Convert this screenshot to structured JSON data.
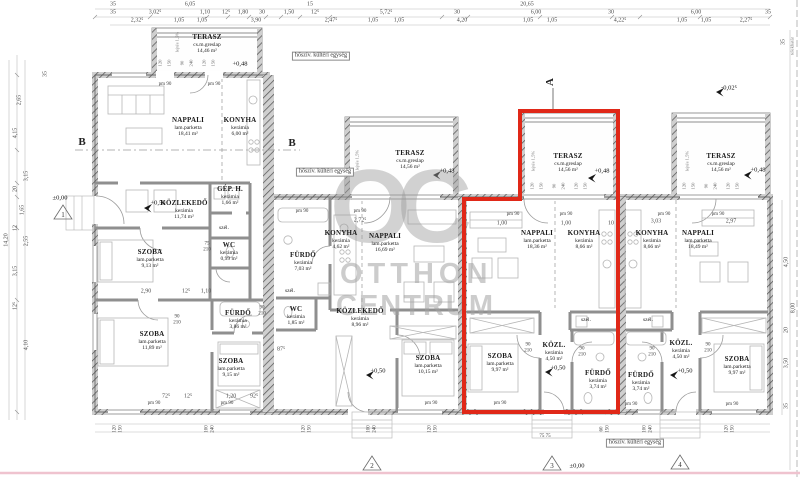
{
  "watermark": {
    "monogram": "OC",
    "line1": "OTTHON",
    "line2": "CENTRUM"
  },
  "labels": {
    "door": "pm 90",
    "heat_pump": "hőszív. kültéri egység",
    "plot_boundary": "telekhatár",
    "slope": "lejtés 1,5%",
    "section_a": "A",
    "section_b": "B"
  },
  "levels": [
    "±0,00",
    "+0,48",
    "+0,48",
    "+0,48",
    "+0,48",
    "+0,50",
    "+0,50",
    "+0,50",
    "+0,50",
    "-0,02⁵",
    "±0,00"
  ],
  "markers": [
    "1",
    "2",
    "3",
    "4"
  ],
  "units": [
    {
      "id": "unit-1",
      "rooms": [
        {
          "name": "TERASZ",
          "material": "cs.m.greslap",
          "area": "14,46 m²"
        },
        {
          "name": "NAPPALI",
          "material": "lam.parketta",
          "area": "18,41 m²"
        },
        {
          "name": "KONYHA",
          "material": "kerámia",
          "area": "6,00 m²"
        },
        {
          "name": "KÖZLEKEDŐ",
          "material": "kerámia",
          "area": "11,74 m²"
        },
        {
          "name": "GÉP. H.",
          "material": "kerámia",
          "area": "1,66 m²"
        },
        {
          "name": "WC",
          "material": "kerámia",
          "area": "0,99 m²"
        },
        {
          "name": "SZOBA",
          "material": "lam.parketta",
          "area": "9,13 m²"
        },
        {
          "name": "SZOBA",
          "material": "lam.parketta",
          "area": "11,89 m²"
        },
        {
          "name": "FÜRDŐ",
          "material": "kerámia",
          "area": "3,86 m²"
        },
        {
          "name": "SZOBA",
          "material": "lam.parketta",
          "area": "9,15 m²"
        },
        {
          "name": "szél."
        }
      ]
    },
    {
      "id": "unit-2",
      "rooms": [
        {
          "name": "TERASZ",
          "material": "cs.m.greslap",
          "area": "14,56 m²"
        },
        {
          "name": "FÜRDŐ",
          "material": "kerámia",
          "area": "7,03 m²"
        },
        {
          "name": "KONYHA",
          "material": "kerámia",
          "area": "4,62 m²"
        },
        {
          "name": "NAPPALI",
          "material": "lam.parketta",
          "area": "16,69 m²"
        },
        {
          "name": "WC",
          "material": "kerámia",
          "area": "1,85 m²"
        },
        {
          "name": "KÖZLEKEDŐ",
          "material": "kerámia",
          "area": "8,96 m²"
        },
        {
          "name": "SZOBA",
          "material": "lam.parketta",
          "area": "10,15 m²"
        },
        {
          "name": "szél."
        }
      ]
    },
    {
      "id": "unit-3",
      "highlighted": true,
      "rooms": [
        {
          "name": "TERASZ",
          "material": "cs.m.greslap",
          "area": "14,56 m²"
        },
        {
          "name": "NAPPALI",
          "material": "lam.parketta",
          "area": "18,36 m²"
        },
        {
          "name": "KONYHA",
          "material": "kerámia",
          "area": "8,66 m²"
        },
        {
          "name": "SZOBA",
          "material": "lam.parketta",
          "area": "9,97 m²"
        },
        {
          "name": "KÖZL.",
          "material": "kerámia",
          "area": "4,50 m²"
        },
        {
          "name": "FÜRDŐ",
          "material": "kerámia",
          "area": "3,74 m²"
        },
        {
          "name": "szél."
        }
      ]
    },
    {
      "id": "unit-4",
      "rooms": [
        {
          "name": "TERASZ",
          "material": "cs.m.greslap",
          "area": "14,56 m²"
        },
        {
          "name": "KONYHA",
          "material": "kerámia",
          "area": "8,66 m²"
        },
        {
          "name": "NAPPALI",
          "material": "lam.parketta",
          "area": "18,49 m²"
        },
        {
          "name": "FÜRDŐ",
          "material": "kerámia",
          "area": "3,74 m²"
        },
        {
          "name": "KÖZL.",
          "material": "kerámia",
          "area": "4,50 m²"
        },
        {
          "name": "SZOBA",
          "material": "lam.parketta",
          "area": "9,97 m²"
        },
        {
          "name": "szél."
        }
      ]
    }
  ],
  "dims": {
    "top1": [
      "35",
      "6,05",
      "15",
      "20,65"
    ],
    "top2": [
      "35",
      "3,02⁵",
      "1,10",
      "12⁵",
      "1,80",
      "30",
      "1,50",
      "12⁵",
      "5,72⁵",
      "30",
      "6,00",
      "30",
      "6,00",
      "35"
    ],
    "top3": [
      "2,32⁵",
      "1,05",
      "1,05",
      "3,90",
      "2,47⁵",
      "1,05",
      "1,05",
      "4,20",
      "1,05",
      "1,05",
      "4,22⁵",
      "1,05",
      "1,05",
      "2,27⁵"
    ],
    "left": [
      "35",
      "2,65",
      "4,15",
      "3,15",
      "20",
      "1,65",
      "12",
      "2,55",
      "3,15",
      "12⁵",
      "4,10",
      "14,20"
    ],
    "right": [
      "35",
      "4,50",
      "8,00",
      "20",
      "3,50",
      "35"
    ],
    "interior": [
      "2,90",
      "12⁵",
      "1,10",
      "2,72⁵",
      "1,00",
      "1,00",
      "10",
      "3,03",
      "2,97",
      "72⁵",
      "12⁵",
      "1,20",
      "92⁵",
      "87⁵"
    ],
    "win": [
      "120",
      "150",
      "90",
      "240",
      "120",
      "150"
    ],
    "door_pairs": [
      [
        "75",
        "210"
      ],
      [
        "90",
        "210"
      ],
      [
        "90",
        "210"
      ],
      [
        "90",
        "210"
      ],
      [
        "90",
        "210"
      ],
      [
        "90",
        "210"
      ],
      [
        "90",
        "210"
      ]
    ],
    "bottom_pairs": [
      [
        "120",
        "150"
      ],
      [
        "100",
        "240"
      ],
      [
        "120",
        "150"
      ],
      [
        "100",
        "240"
      ],
      [
        "120",
        "150"
      ],
      [
        "60",
        "150"
      ],
      [
        "100",
        "240"
      ],
      [
        "120",
        "150"
      ],
      [
        "75",
        "75"
      ]
    ]
  }
}
